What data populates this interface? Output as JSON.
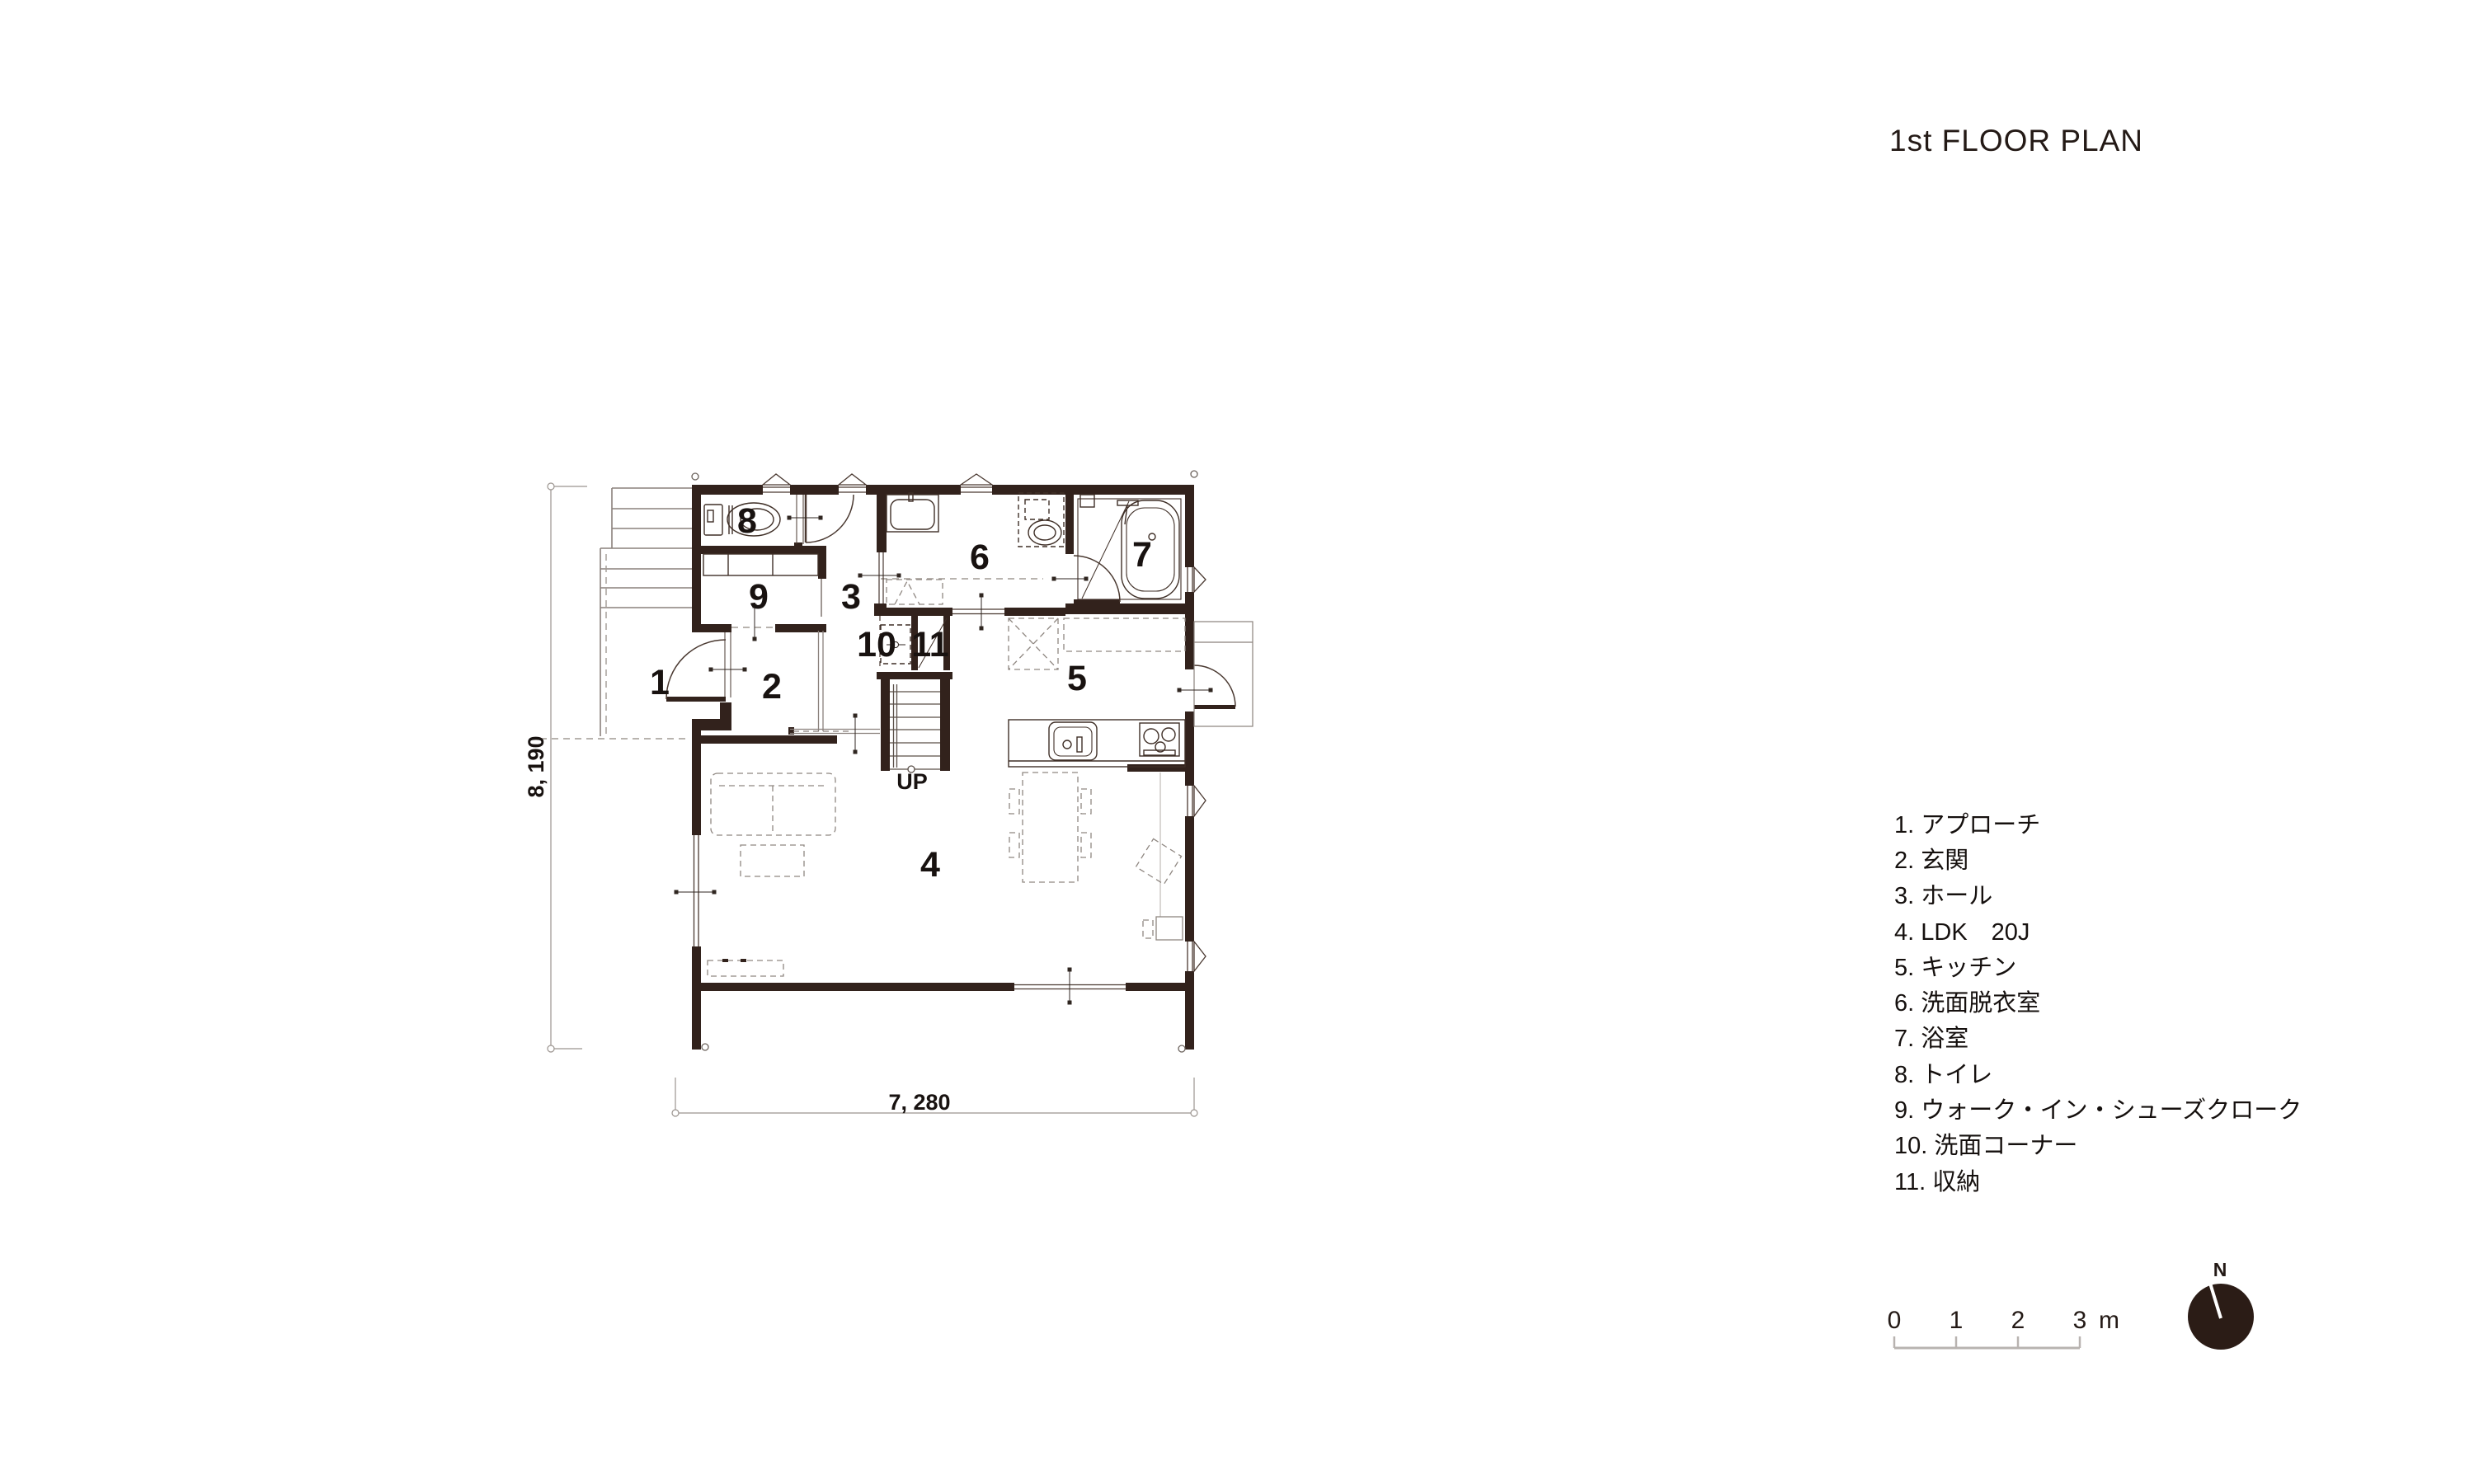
{
  "title": "1st FLOOR PLAN",
  "plan": {
    "room_numbers": [
      "1",
      "2",
      "3",
      "4",
      "5",
      "6",
      "7",
      "8",
      "9",
      "10",
      "11"
    ],
    "up_label": "UP",
    "dim_width": "7, 280",
    "dim_height": "8, 190"
  },
  "legend": {
    "items": [
      "1. アプローチ",
      "2. 玄関",
      "3. ホール",
      "4. LDK　20J",
      "5. キッチン",
      "6. 洗面脱衣室",
      "7. 浴室",
      "8. トイレ",
      "9. ウォーク・イン・シューズクローク",
      "10. 洗面コーナー",
      "11. 収納"
    ]
  },
  "scale_bar": {
    "ticks": [
      "0",
      "1",
      "2",
      "3"
    ],
    "unit_label": "m"
  },
  "compass": {
    "north_label": "N"
  },
  "colors": {
    "wall": "#32221c",
    "line": "#3f2f27",
    "gray": "#9b948f",
    "text": "#181210"
  }
}
